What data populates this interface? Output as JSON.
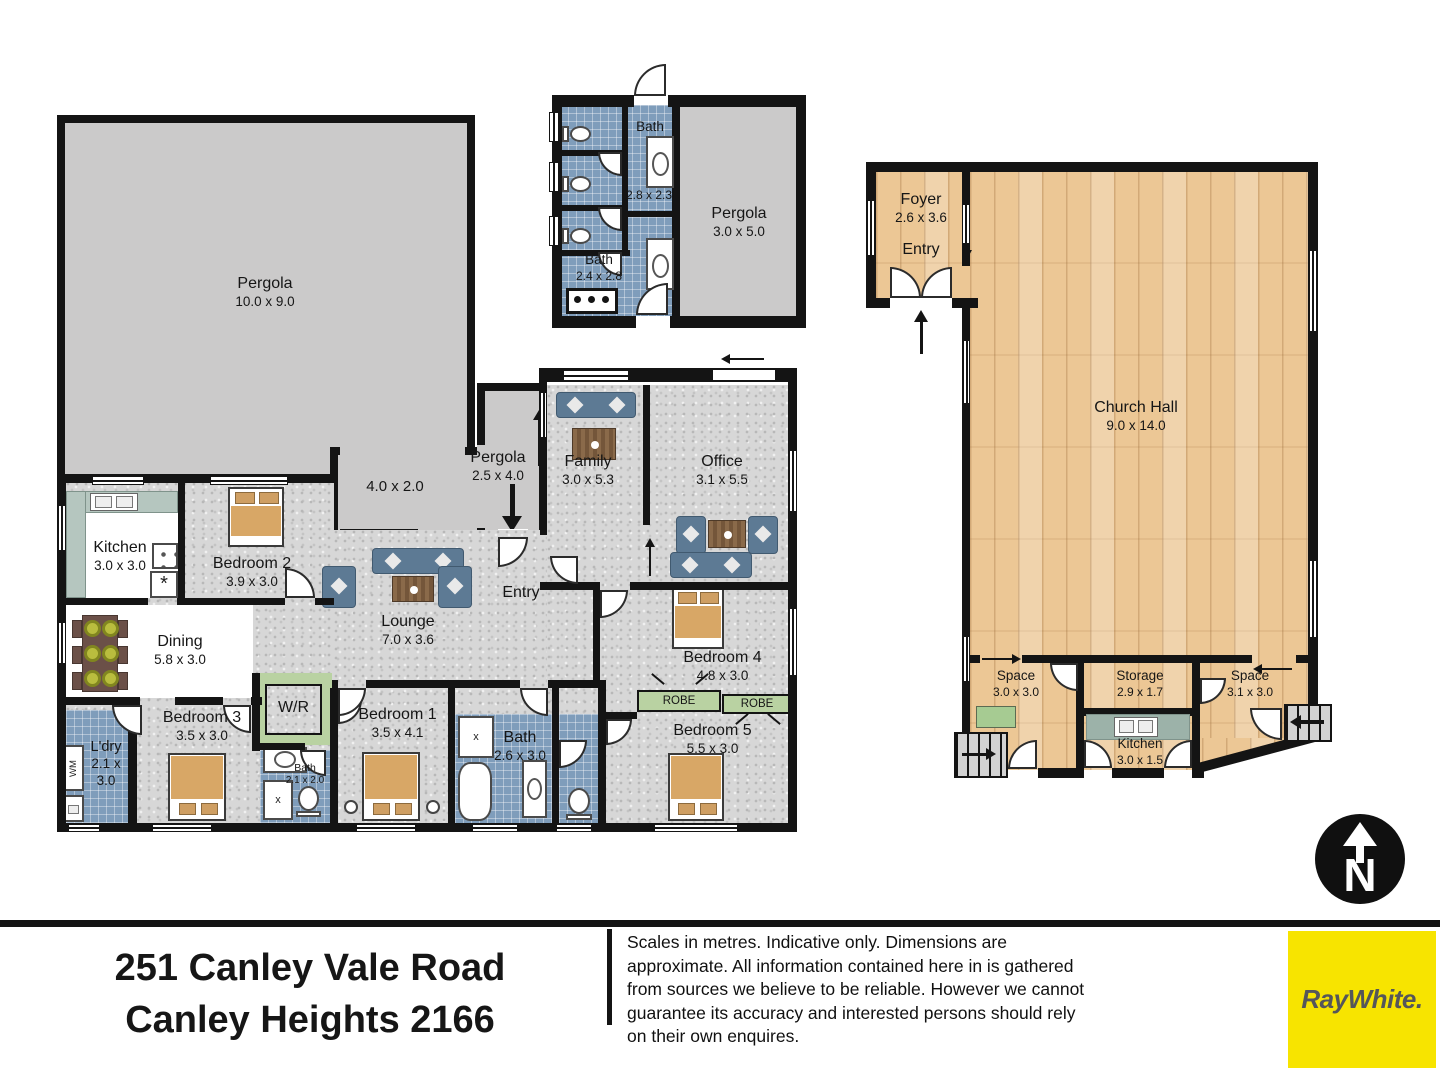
{
  "rooms": {
    "pergola_big": {
      "name": "Pergola",
      "dims": "10.0 x 9.0"
    },
    "pergola_ext": {
      "dims": "4.0 x 2.0"
    },
    "pergola_side": {
      "name": "Pergola",
      "dims": "2.5 x 4.0"
    },
    "wc_bath_top": {
      "name": "Bath",
      "dims": "2.8 x 2.3"
    },
    "wc_bath_low": {
      "name": "Bath",
      "dims": "2.4 x 2.8"
    },
    "wc_pergola": {
      "name": "Pergola",
      "dims": "3.0 x 5.0"
    },
    "kitchen": {
      "name": "Kitchen",
      "dims": "3.0 x 3.0"
    },
    "bedroom2": {
      "name": "Bedroom 2",
      "dims": "3.9 x 3.0"
    },
    "family": {
      "name": "Family",
      "dims": "3.0 x 5.3"
    },
    "office": {
      "name": "Office",
      "dims": "3.1 x 5.5"
    },
    "entry": {
      "name": "Entry"
    },
    "lounge": {
      "name": "Lounge",
      "dims": "7.0 x 3.6"
    },
    "dining": {
      "name": "Dining",
      "dims": "5.8 x 3.0"
    },
    "bedroom4": {
      "name": "Bedroom 4",
      "dims": "4.8 x 3.0"
    },
    "robe_a": {
      "name": "ROBE"
    },
    "robe_b": {
      "name": "ROBE"
    },
    "wr": {
      "name": "W/R"
    },
    "bedroom3": {
      "name": "Bedroom 3",
      "dims": "3.5 x 3.0"
    },
    "ldry": {
      "name": "L'dry",
      "dims": "2.1 x 3.0"
    },
    "wm": {
      "name": "WM"
    },
    "bath_small": {
      "name": "Bath",
      "dims": "2.1 x 2.0"
    },
    "bedroom1": {
      "name": "Bedroom 1",
      "dims": "3.5 x 4.1"
    },
    "bath_main": {
      "name": "Bath",
      "dims": "2.6 x 3.0"
    },
    "bedroom5": {
      "name": "Bedroom 5",
      "dims": "5.5 x 3.0"
    },
    "foyer": {
      "name": "Foyer",
      "dims": "2.6 x 3.6",
      "entry": "Entry"
    },
    "church_hall": {
      "name": "Church Hall",
      "dims": "9.0 x 14.0"
    },
    "space_left": {
      "name": "Space",
      "dims": "3.0 x 3.0"
    },
    "storage": {
      "name": "Storage",
      "dims": "2.9 x 1.7"
    },
    "space_right": {
      "name": "Space",
      "dims": "3.1 x 3.0"
    },
    "church_kitchen": {
      "name": "Kitchen",
      "dims": "3.0 x 1.5"
    }
  },
  "fixtures": {
    "shower_mark": "x",
    "dishwasher_mark": "*"
  },
  "footer": {
    "address_line1": "251 Canley Vale Road",
    "address_line2": "Canley Heights 2166",
    "disclaimer": "Scales in metres. Indicative only. Dimensions are approximate. All information contained here in is gathered from sources we believe to be reliable. However we cannot guarantee its accuracy and interested persons should rely on their own enquires.",
    "brand": "RayWhite.",
    "compass_letter": "N"
  },
  "colors": {
    "brand_yellow": "#F7E400",
    "brand_text": "#55565A",
    "wall": "#141414",
    "carpet": "#D7D7D7",
    "tile": "#7F9DBB",
    "wood": "#ECC795",
    "pergola_gray": "#CBCACA",
    "robe_green": "#B9D2A2"
  }
}
